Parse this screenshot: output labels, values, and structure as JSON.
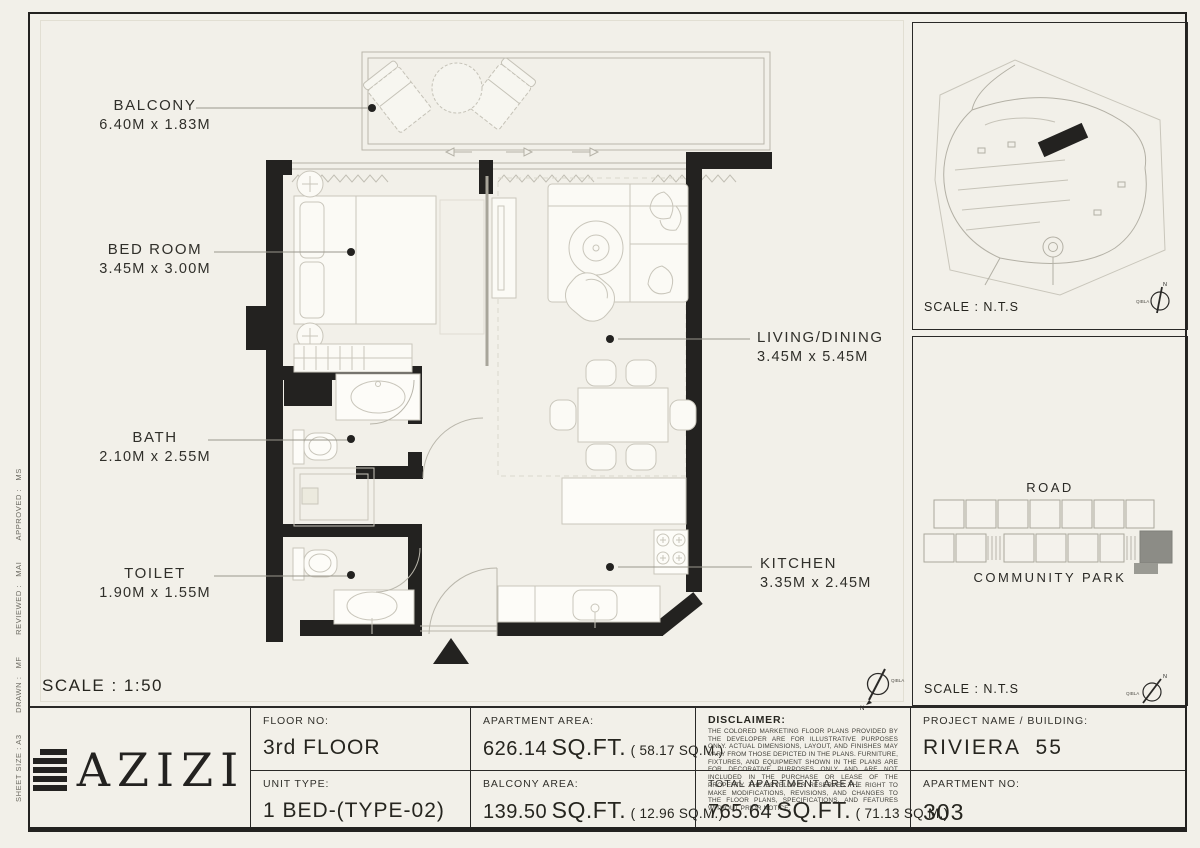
{
  "sheet": {
    "scale_main": "SCALE : 1:50",
    "meta_vertical": "SHEET SIZE : A3        DRAWN :   MF        REVIEWED :   MAI        APPROVED :   MS"
  },
  "compass": {
    "north": "N",
    "qibla": "QIBLA"
  },
  "rooms": {
    "balcony": {
      "name": "BALCONY",
      "dims": "6.40M x 1.83M"
    },
    "bedroom": {
      "name": "BED ROOM",
      "dims": "3.45M x 3.00M"
    },
    "bath": {
      "name": "BATH",
      "dims": "2.10M x 2.55M"
    },
    "toilet": {
      "name": "TOILET",
      "dims": "1.90M x 1.55M"
    },
    "living": {
      "name": "LIVING/DINING",
      "dims": "3.45M x 5.45M"
    },
    "kitchen": {
      "name": "KITCHEN",
      "dims": "3.35M x 2.45M"
    }
  },
  "site_panel": {
    "scale": "SCALE : N.T.S"
  },
  "key_panel": {
    "road": "ROAD",
    "park": "COMMUNITY PARK",
    "scale": "SCALE : N.T.S"
  },
  "title_block": {
    "brand": "AZIZI",
    "floor": {
      "label": "FLOOR NO:",
      "value": "3rd FLOOR"
    },
    "unit_type": {
      "label": "UNIT TYPE:",
      "value": "1 BED-(TYPE-02)"
    },
    "apartment_area": {
      "label": "APARTMENT AREA:",
      "value": "626.14",
      "unit": "SQ.FT.",
      "metric": "(  58.17 SQ.M.)"
    },
    "balcony_area": {
      "label": "BALCONY AREA:",
      "value": "139.50",
      "unit": "SQ.FT.",
      "metric": "(  12.96 SQ.M.)"
    },
    "total_area": {
      "label": "TOTAL APARTMENT AREA:",
      "value": "765.64",
      "unit": "SQ.FT.",
      "metric": "(  71.13 SQ.M.)"
    },
    "disclaimer": {
      "label": "DISCLAIMER:",
      "text": "THE COLORED MARKETING FLOOR PLANS PROVIDED BY THE DEVELOPER ARE FOR ILLUSTRATIVE PURPOSES ONLY. ACTUAL DIMENSIONS, LAYOUT, AND FINISHES MAY VARY FROM THOSE DEPICTED IN THE PLANS. FURNITURE, FIXTURES, AND EQUIPMENT SHOWN IN THE PLANS ARE FOR DECORATIVE PURPOSES ONLY AND ARE NOT INCLUDED IN THE PURCHASE OR LEASE OF THE PROPERTY. THE DEVELOPER RESERVES THE RIGHT TO MAKE MODIFICATIONS, REVISIONS, AND CHANGES TO THE FLOOR PLANS, SPECIFICATIONS, AND FEATURES WITHOUT PRIOR NOTICE."
    },
    "project": {
      "label": "PROJECT NAME / BUILDING:",
      "value": "RIVIERA  55"
    },
    "apartment_no": {
      "label": "APARTMENT NO:",
      "value": "303"
    }
  },
  "colors": {
    "ink": "#232220",
    "paper": "#f2f0e9",
    "highlight_unit": "#8c8c86"
  }
}
